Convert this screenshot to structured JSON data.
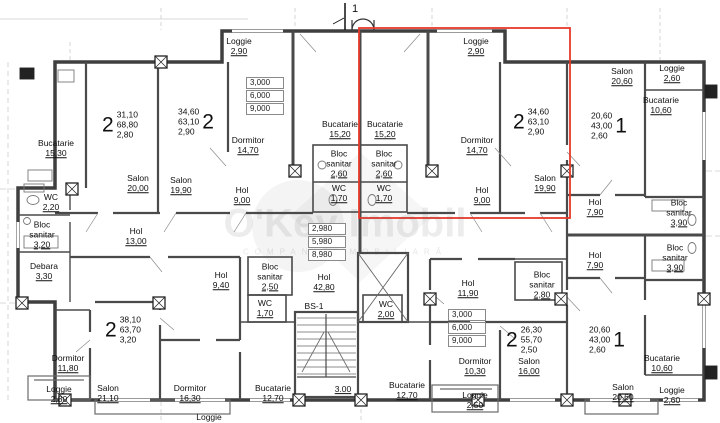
{
  "watermark": {
    "brand": "O'Key Imobil",
    "tagline": "COMPANIE IMOBILIARĂ"
  },
  "section_marker": {
    "label": "1"
  },
  "highlight": {
    "color": "#e8392b"
  },
  "room_labels": [
    {
      "name": "Bucatarie",
      "value": "15,30",
      "x": 56,
      "y": 149
    },
    {
      "name": "Salon",
      "value": "20,00",
      "x": 138,
      "y": 184
    },
    {
      "name": "Salon",
      "value": "19,90",
      "x": 181,
      "y": 186
    },
    {
      "name": "WC",
      "value": "2,20",
      "x": 51,
      "y": 203
    },
    {
      "name": "Bloc sanitar",
      "value": "3,20",
      "x": 42,
      "y": 235,
      "w": 40
    },
    {
      "name": "Debara",
      "value": "3,30",
      "x": 44,
      "y": 272
    },
    {
      "name": "Hol",
      "value": "13,00",
      "x": 136,
      "y": 237
    },
    {
      "name": "Loggie",
      "value": "2,90",
      "x": 239,
      "y": 47
    },
    {
      "name": "Dormitor",
      "value": "14,70",
      "x": 248,
      "y": 146
    },
    {
      "name": "Bucatarie",
      "value": "15,20",
      "x": 340,
      "y": 130
    },
    {
      "name": "Bucatarie",
      "value": "15,20",
      "x": 385,
      "y": 130
    },
    {
      "name": "Bloc sanitar",
      "value": "2,60",
      "x": 339,
      "y": 164,
      "w": 40
    },
    {
      "name": "Bloc sanitar",
      "value": "2,60",
      "x": 384,
      "y": 164,
      "w": 40
    },
    {
      "name": "WC",
      "value": "1,70",
      "x": 339,
      "y": 194
    },
    {
      "name": "WC",
      "value": "1,70",
      "x": 384,
      "y": 194
    },
    {
      "name": "Hol",
      "value": "9,00",
      "x": 242,
      "y": 196
    },
    {
      "name": "Hol",
      "value": "9,00",
      "x": 482,
      "y": 196
    },
    {
      "name": "Loggie",
      "value": "2,90",
      "x": 476,
      "y": 47
    },
    {
      "name": "Dormitor",
      "value": "14,70",
      "x": 477,
      "y": 146
    },
    {
      "name": "Salon",
      "value": "19,90",
      "x": 545,
      "y": 184
    },
    {
      "name": "Salon",
      "value": "20,60",
      "x": 622,
      "y": 77
    },
    {
      "name": "Loggie",
      "value": "2,60",
      "x": 672,
      "y": 74
    },
    {
      "name": "Bucatarie",
      "value": "10,60",
      "x": 661,
      "y": 106
    },
    {
      "name": "Hol",
      "value": "7,90",
      "x": 595,
      "y": 208
    },
    {
      "name": "Bloc sanitar",
      "value": "3,90",
      "x": 679,
      "y": 213,
      "w": 40
    },
    {
      "name": "Hol",
      "value": "7,90",
      "x": 595,
      "y": 261
    },
    {
      "name": "Bloc sanitar",
      "value": "3,90",
      "x": 675,
      "y": 258,
      "w": 40
    },
    {
      "name": "Hol",
      "value": "9,40",
      "x": 221,
      "y": 281
    },
    {
      "name": "Bloc sanitar",
      "value": "2,50",
      "x": 270,
      "y": 277,
      "w": 40
    },
    {
      "name": "Hol",
      "value": "42,80",
      "x": 324,
      "y": 283
    },
    {
      "name": "WC",
      "value": "1,70",
      "x": 265,
      "y": 309
    },
    {
      "name": "BS-1",
      "value": "",
      "x": 314,
      "y": 307
    },
    {
      "name": "WC",
      "value": "2,00",
      "x": 386,
      "y": 310
    },
    {
      "name": "Hol",
      "value": "11,90",
      "x": 468,
      "y": 289
    },
    {
      "name": "Bloc sanitar",
      "value": "2,80",
      "x": 542,
      "y": 285,
      "w": 40
    },
    {
      "name": "Dormitor",
      "value": "11,80",
      "x": 68,
      "y": 364
    },
    {
      "name": "Loggie",
      "value": "2,80",
      "x": 59,
      "y": 395
    },
    {
      "name": "Salon",
      "value": "21,10",
      "x": 108,
      "y": 394
    },
    {
      "name": "Dormitor",
      "value": "16,30",
      "x": 190,
      "y": 394
    },
    {
      "name": "Bucatarie",
      "value": "12,70",
      "x": 273,
      "y": 394
    },
    {
      "name": "",
      "value": "3.00",
      "x": 343,
      "y": 390
    },
    {
      "name": "Bucatarie",
      "value": "12,70",
      "x": 407,
      "y": 391
    },
    {
      "name": "Dormitor",
      "value": "10,30",
      "x": 475,
      "y": 367
    },
    {
      "name": "Loggie",
      "value": "2,50",
      "x": 475,
      "y": 401
    },
    {
      "name": "Salon",
      "value": "16,00",
      "x": 529,
      "y": 367
    },
    {
      "name": "Bucatarie",
      "value": "10,60",
      "x": 662,
      "y": 364
    },
    {
      "name": "Salon",
      "value": "20,60",
      "x": 623,
      "y": 393
    },
    {
      "name": "Loggie",
      "value": "2,60",
      "x": 672,
      "y": 396
    },
    {
      "name": "Loggie",
      "value": "",
      "x": 209,
      "y": 418
    }
  ],
  "apartment_summaries": [
    {
      "digit": "2",
      "digit_side": "left",
      "lines": [
        "31,10",
        "68,80",
        "2,80"
      ],
      "x": 120,
      "y": 125
    },
    {
      "digit": "2",
      "digit_side": "right",
      "lines": [
        "34,60",
        "63,10",
        "2,90"
      ],
      "x": 196,
      "y": 122
    },
    {
      "digit": "2",
      "digit_side": "left",
      "lines": [
        "34,60",
        "63,10",
        "2,90"
      ],
      "x": 531,
      "y": 122
    },
    {
      "digit": "1",
      "digit_side": "right",
      "lines": [
        "20,60",
        "43,00",
        "2,60"
      ],
      "x": 609,
      "y": 126
    },
    {
      "digit": "2",
      "digit_side": "left",
      "lines": [
        "38,10",
        "63,70",
        "3,20"
      ],
      "x": 123,
      "y": 330
    },
    {
      "digit": "2",
      "digit_side": "left",
      "lines": [
        "26,30",
        "55,70",
        "2,50"
      ],
      "x": 524,
      "y": 340
    },
    {
      "digit": "1",
      "digit_side": "right",
      "lines": [
        "20,60",
        "43,00",
        "2,60"
      ],
      "x": 607,
      "y": 340
    }
  ],
  "elevation_boxes": [
    {
      "values": [
        "3,000",
        "6,000",
        "9,000"
      ],
      "x": 265,
      "y": 96
    },
    {
      "values": [
        "2,980",
        "5,980",
        "8,980"
      ],
      "x": 327,
      "y": 242
    },
    {
      "values": [
        "3,000",
        "6,000",
        "9,000"
      ],
      "x": 467,
      "y": 328
    }
  ]
}
